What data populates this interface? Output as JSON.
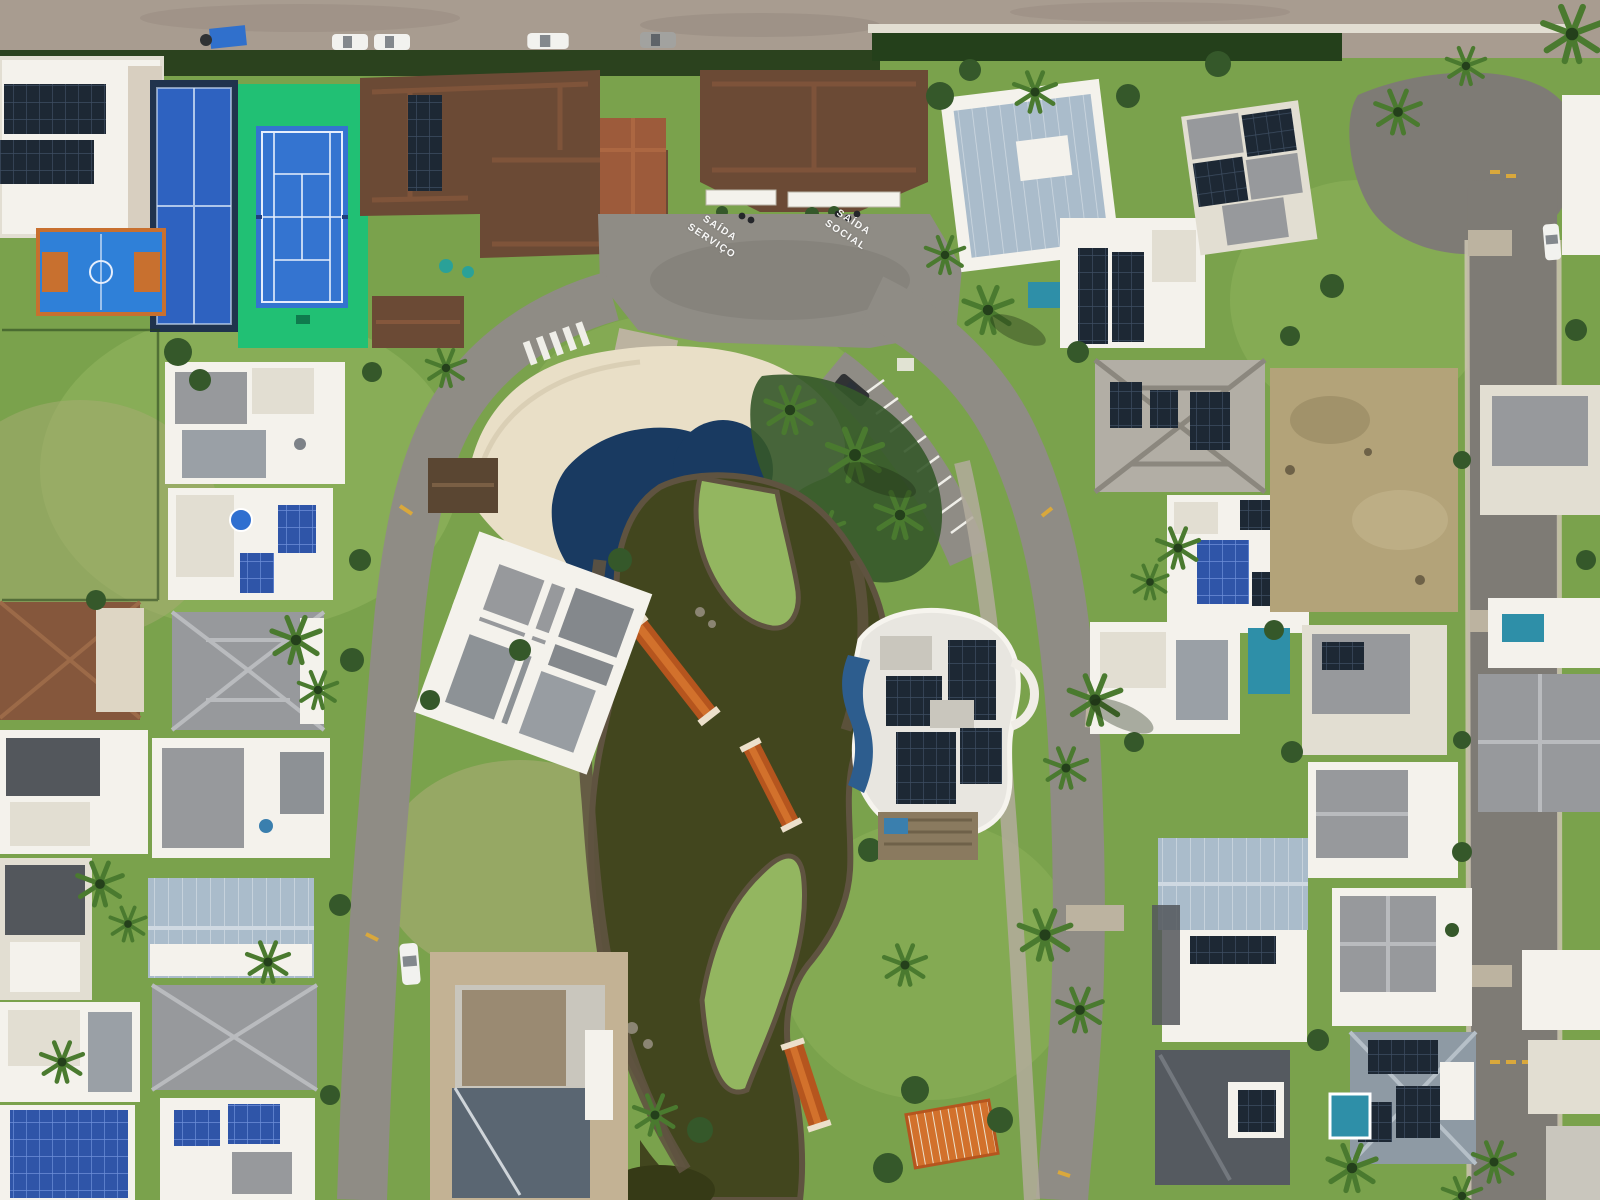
{
  "scene": {
    "type": "aerial-photograph",
    "setting": "daytime aerial view of a beachfront gated residential community with central pool, pond, sports courts and modern solar-roofed houses"
  },
  "road_markings": {
    "service_exit": "SAÍDA\nSERVIÇO",
    "social_exit": "SAÍDA\nSOCIAL"
  },
  "counts": {
    "cars_on_beach_road": 4,
    "footbridges_over_pond": 3,
    "sports_courts": 3
  },
  "colors": {
    "grass": "#7aa24c",
    "grassLight": "#93b660",
    "grassDark": "#5e8a3d",
    "grassPale": "#a8ab74",
    "dry": "#b3a379",
    "sand": "#c3b294",
    "beach": "#a89c90",
    "beachDark": "#93887c",
    "asphalt": "#8f8c85",
    "asphaltDark": "#75726c",
    "roadRight": "#7e7b75",
    "paver": "#bcb3a0",
    "sidewalk": "#cdc5b2",
    "pond": "#42461e",
    "pondDark": "#363a16",
    "mud": "#5f5340",
    "pool": "#193a61",
    "poolLight": "#9fc7cf",
    "deck": "#e9dfc7",
    "bridge": "#b5551e",
    "bridgeLight": "#d2712c",
    "rail": "#ece0cb",
    "courtGreen": "#21c074",
    "courtBlue": "#3474d0",
    "padelBlue": "#2e62c0",
    "padelDark": "#20334d",
    "bballBlue": "#2f80d8",
    "bballOrange": "#c8702f",
    "roofBrown": "#6b4a35",
    "roofBrownLight": "#85573c",
    "roofTerra": "#9d5b3b",
    "white": "#f4f2ec",
    "offWhite": "#e2ded2",
    "roofGray": "#97999c",
    "roofDark": "#53575c",
    "roofSteel": "#aabccb",
    "concrete": "#c9c6bd",
    "solar": "#1d2834",
    "solarBlue": "#2f55a8",
    "hedge": "#2b421e",
    "tree": "#35582a",
    "treeDark": "#24401b",
    "palm": "#4a7a2f",
    "poolTeal": "#2e8fa8",
    "carWhite": "#f2f2ef",
    "carGray": "#a2a29f",
    "carDark": "#303234",
    "tarp": "#3070cc",
    "yellow": "#d9a83c"
  }
}
